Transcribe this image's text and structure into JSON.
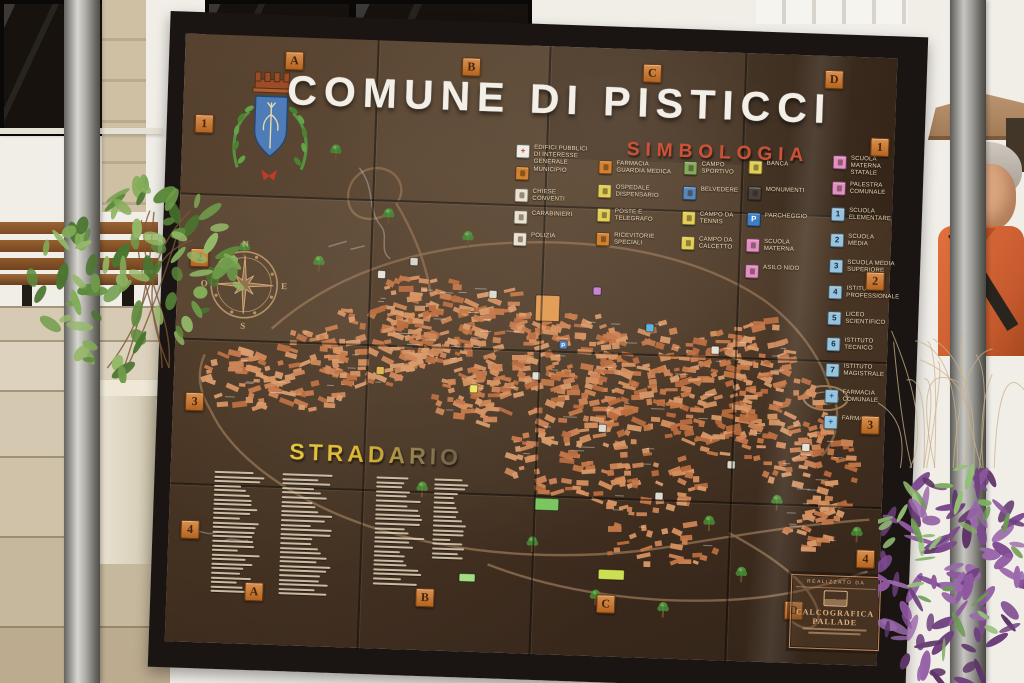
{
  "palette": {
    "board_brown": "#42301f",
    "frame_black": "#1a1512",
    "map_orange": "#cd8455",
    "title_white": "#f4efe6",
    "legend_red": "#cd5136",
    "stradario_yellow": "#d9ba3a",
    "grid_label_orange": "#c87c3f"
  },
  "sign": {
    "title": "COMUNE DI PISTICCI",
    "legend_title": "SIMBOLOGIA",
    "street_index_title": "STRADARIO",
    "grid_cols": [
      "A",
      "B",
      "C",
      "D"
    ],
    "grid_rows": [
      "1",
      "2",
      "3",
      "4"
    ],
    "compass": {
      "north": "N",
      "south": "S",
      "east": "E",
      "west": "O"
    },
    "legend_groups": [
      {
        "items": [
          {
            "icon_name": "red-cross-icon",
            "bg": "#f2ede4",
            "glyph": "+",
            "glyph_color": "#c0392b",
            "label": "EDIFICI PUBBLICI\nDI INTERESSE GENERALE"
          },
          {
            "icon_name": "municipio-icon",
            "bg": "#d3812f",
            "label": "MUNICIPIO"
          },
          {
            "icon_name": "chiese-icon",
            "bg": "#ece2cf",
            "label": "CHIESE\nCONVENTI"
          },
          {
            "icon_name": "carabinieri-icon",
            "bg": "#ece2cf",
            "label": "CARABINIERI"
          },
          {
            "icon_name": "polizia-icon",
            "bg": "#ece2cf",
            "label": "POLIZIA"
          }
        ]
      },
      {
        "items": [
          {
            "icon_name": "guardia-medica-icon",
            "bg": "#d3812f",
            "label": "FARMACIA\nGUARDIA MEDICA"
          },
          {
            "icon_name": "ospedale-icon",
            "bg": "#e3cf58",
            "label": "OSPEDALE\nDISPENSARIO"
          },
          {
            "icon_name": "poste-icon",
            "bg": "#e3cf58",
            "label": "POSTE E\nTELEGRAFO"
          },
          {
            "icon_name": "ricevitorie-icon",
            "bg": "#d3812f",
            "label": "RICEVITORIE\nSPECIALI"
          }
        ]
      },
      {
        "items": [
          {
            "icon_name": "campo-sportivo-icon",
            "bg": "#86a85c",
            "label": "CAMPO\nSPORTIVO"
          },
          {
            "icon_name": "belvedere-icon",
            "bg": "#5a87b5",
            "label": "BELVEDERE"
          },
          {
            "icon_name": "tennis-icon",
            "bg": "#e3cf58",
            "label": "CAMPO DA\nTENNIS"
          },
          {
            "icon_name": "calcetto-icon",
            "bg": "#e3cf58",
            "label": "CAMPO DA\nCALCETTO"
          }
        ]
      },
      {
        "items": [
          {
            "icon_name": "banca-icon",
            "bg": "#e3cf58",
            "label": "BANCA"
          },
          {
            "icon_name": "monumenti-icon",
            "bg": "#4a423a",
            "label": "MONUMENTI"
          },
          {
            "icon_name": "parcheggio-icon",
            "bg": "#3f7ec7",
            "glyph": "P",
            "glyph_color": "#ffffff",
            "label": "PARCHEGGIO"
          },
          {
            "icon_name": "scuola-materna-icon",
            "bg": "#e48ec2",
            "label": "SCUOLA\nMATERNA"
          },
          {
            "icon_name": "asilo-nido-icon",
            "bg": "#e48ec2",
            "label": "ASILO NIDO"
          }
        ]
      },
      {
        "items": [
          {
            "icon_name": "scuola-materna-statale-icon",
            "bg": "#e48ec2",
            "label": "SCUOLA MATERNA\nSTATALE"
          },
          {
            "icon_name": "palestra-icon",
            "bg": "#e48ec2",
            "label": "PALESTRA\nCOMUNALE"
          },
          {
            "icon_name": "scuola-1-icon",
            "bg": "#96c3dd",
            "glyph": "1",
            "label": "SCUOLA\nELEMENTARE"
          },
          {
            "icon_name": "scuola-2-icon",
            "bg": "#96c3dd",
            "glyph": "2",
            "label": "SCUOLA\nMEDIA"
          },
          {
            "icon_name": "scuola-3-icon",
            "bg": "#96c3dd",
            "glyph": "3",
            "label": "SCUOLA MEDIA\nSUPERIORE"
          },
          {
            "icon_name": "scuola-4-icon",
            "bg": "#96c3dd",
            "glyph": "4",
            "label": "ISTITUTO\nPROFESSIONALE"
          },
          {
            "icon_name": "scuola-5-icon",
            "bg": "#96c3dd",
            "glyph": "5",
            "label": "LICEO\nSCIENTIFICO"
          },
          {
            "icon_name": "scuola-6-icon",
            "bg": "#96c3dd",
            "glyph": "6",
            "label": "ISTITUTO\nTECNICO"
          },
          {
            "icon_name": "scuola-7-icon",
            "bg": "#96c3dd",
            "glyph": "7",
            "label": "ISTITUTO\nMAGISTRALE"
          },
          {
            "icon_name": "farmacia-comunale-icon",
            "bg": "#96c3dd",
            "glyph": "+",
            "glyph_color": "#1f5f8a",
            "label": "FARMACIA\nCOMUNALE"
          },
          {
            "icon_name": "farmacia-icon",
            "bg": "#96c3dd",
            "glyph": "+",
            "glyph_color": "#1f5f8a",
            "label": "FARMACIA"
          }
        ]
      }
    ],
    "map_markers": [
      {
        "x": 204,
        "y": 234,
        "color": "#e8e4da"
      },
      {
        "x": 236,
        "y": 220,
        "color": "#d8d4ca"
      },
      {
        "x": 371,
        "y": 262,
        "color": "#e29a52",
        "w": 24,
        "h": 26
      },
      {
        "x": 420,
        "y": 243,
        "color": "#c77fd4"
      },
      {
        "x": 388,
        "y": 298,
        "color": "#4f86c9",
        "glyph": "P"
      },
      {
        "x": 362,
        "y": 330,
        "color": "#e4e0d4"
      },
      {
        "x": 300,
        "y": 345,
        "color": "#efe662"
      },
      {
        "x": 377,
        "y": 458,
        "color": "#78c55e",
        "w": 24,
        "h": 12
      },
      {
        "x": 444,
        "y": 526,
        "color": "#cbdf52",
        "w": 26,
        "h": 10
      },
      {
        "x": 300,
        "y": 534,
        "color": "#a0dd80",
        "w": 16,
        "h": 8
      },
      {
        "x": 489,
        "y": 446,
        "color": "#dedad0"
      },
      {
        "x": 560,
        "y": 412,
        "color": "#dedad0"
      },
      {
        "x": 634,
        "y": 392,
        "color": "#e6e2d8"
      },
      {
        "x": 540,
        "y": 298,
        "color": "#e6e2d8"
      },
      {
        "x": 474,
        "y": 278,
        "color": "#5ab4dd"
      },
      {
        "x": 316,
        "y": 250,
        "color": "#dedad0"
      },
      {
        "x": 206,
        "y": 330,
        "color": "#e0b44e"
      },
      {
        "x": 430,
        "y": 380,
        "color": "#dedad0"
      }
    ],
    "plaque": {
      "heading": "REALIZZATO DA",
      "name_line1": "CALCOGRAFICA",
      "name_line2": "PALLADE"
    }
  }
}
